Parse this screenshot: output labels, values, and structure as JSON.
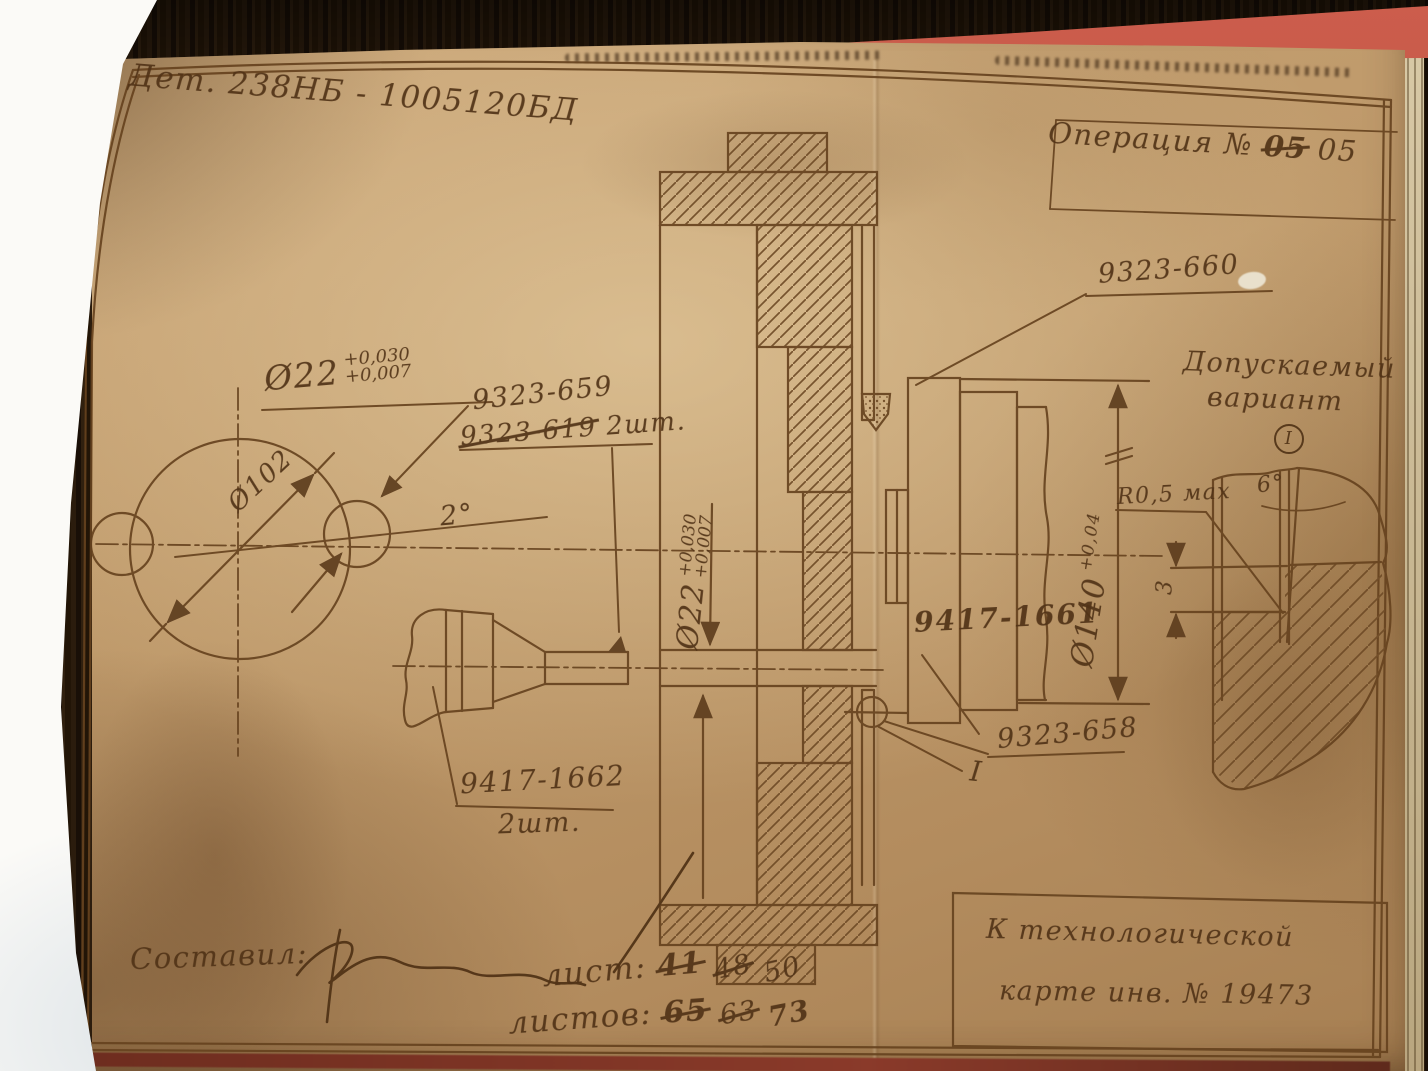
{
  "colors": {
    "ink": "#513317",
    "paper": "#c29c6e",
    "folder_red": "#bf5243",
    "wood": "#241808",
    "pages_white": "#f2f1ec"
  },
  "title_block": {
    "part_label": "Дет. 238НБ - 1005120БД",
    "operation_label": "Операция №",
    "operation_old": "05",
    "operation_new": "05"
  },
  "part_labels": {
    "grinding_segment": "9323-660",
    "bushing": "9323-659",
    "bushing_old": "9323-619",
    "bushing_qty": "2шт.",
    "holder": "9417-1661",
    "center": "9323-658",
    "section_marker": "I",
    "cutter": "9417-1662",
    "cutter_qty": "2шт."
  },
  "dimensions": {
    "bore_dia": "Ø22",
    "bore_tol_upper": "+0,030",
    "bore_tol_lower": "+0,007",
    "bolt_circle_dia": "Ø102",
    "hole_angle": "2°",
    "outer_dia": "Ø140",
    "outer_tol": "+0,04",
    "fillet": "R0,5 мах",
    "chamfer_angle": "6°",
    "chamfer_depth": "3"
  },
  "variant_note": {
    "line1": "Допускаемый",
    "line2": "вариант",
    "marker": "I"
  },
  "footer": {
    "author_label": "Составил:",
    "sheet_label": "лист:",
    "sheet_numbers": [
      {
        "v": "41"
      },
      {
        "v": "48"
      },
      {
        "v": "50"
      }
    ],
    "sheets_label": "листов:",
    "sheets_numbers": [
      {
        "v": "65"
      },
      {
        "v": "63"
      },
      {
        "v": "73"
      }
    ],
    "tech_line1": "К технологической",
    "tech_line2": "карте инв. № 19473"
  }
}
